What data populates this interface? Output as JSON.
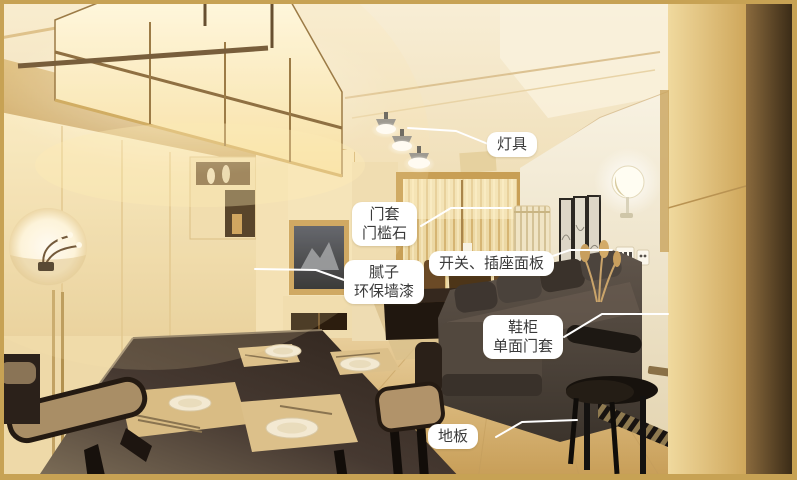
{
  "image": {
    "kind": "annotated interior renovation photo",
    "room": "living-dining room"
  },
  "colors": {
    "frame_border": "#c7a254",
    "label_bg": "#ffffff",
    "label_text": "#3a3a3a",
    "leader_line": "#ffffff"
  },
  "annotations": [
    {
      "id": "lighting",
      "label": "灯具",
      "box": {
        "x": 487,
        "y": 132
      },
      "line": [
        [
          408,
          128
        ],
        [
          456,
          131
        ],
        [
          488,
          144
        ]
      ]
    },
    {
      "id": "door-frame",
      "label": "门套\n门槛石",
      "box": {
        "x": 352,
        "y": 202
      },
      "line": [
        [
          511,
          208
        ],
        [
          451,
          208
        ],
        [
          421,
          226
        ]
      ]
    },
    {
      "id": "switch-socket",
      "label": "开关、插座面板",
      "box": {
        "x": 429,
        "y": 251
      },
      "line": [
        [
          612,
          250
        ],
        [
          570,
          250
        ],
        [
          550,
          257
        ]
      ]
    },
    {
      "id": "putty-paint",
      "label": "腻子\n环保墙漆",
      "box": {
        "x": 344,
        "y": 260
      },
      "line": [
        [
          255,
          269
        ],
        [
          316,
          270
        ],
        [
          347,
          281
        ]
      ]
    },
    {
      "id": "shoe-cabinet",
      "label": "鞋柜\n单面门套",
      "box": {
        "x": 483,
        "y": 315
      },
      "line": [
        [
          668,
          314
        ],
        [
          602,
          314
        ],
        [
          564,
          337
        ]
      ]
    },
    {
      "id": "floor",
      "label": "地板",
      "box": {
        "x": 428,
        "y": 424
      },
      "line": [
        [
          577,
          420
        ],
        [
          522,
          422
        ],
        [
          496,
          437
        ]
      ]
    }
  ]
}
